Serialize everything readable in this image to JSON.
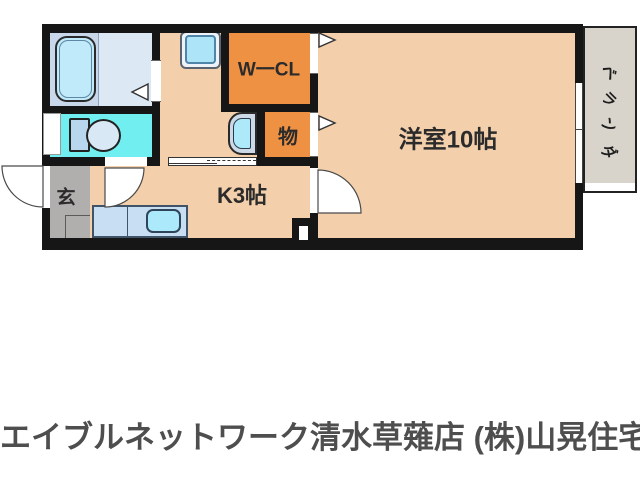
{
  "plan": {
    "rooms": {
      "western_room": "洋室10帖",
      "kitchen": "K3帖",
      "walk_in_closet": "W一CL",
      "storage": "物",
      "entrance": "玄",
      "veranda": "ベランダ"
    },
    "colors": {
      "wall": "#161616",
      "floor_peach": "#f3d0ab",
      "closet_orange": "#ef9143",
      "toilet_cyan": "#70eef0",
      "bath_floor": "#dce8f4",
      "bath_tub_zone": "#c8d7e9",
      "fixture_blue": "#aee4f8",
      "genkan_gray": "#b1aeae",
      "veranda_gray": "#d9d4cb"
    }
  },
  "footer": {
    "agency": "エイブルネットワーク清水草薙店 (株)山晃住宅"
  }
}
